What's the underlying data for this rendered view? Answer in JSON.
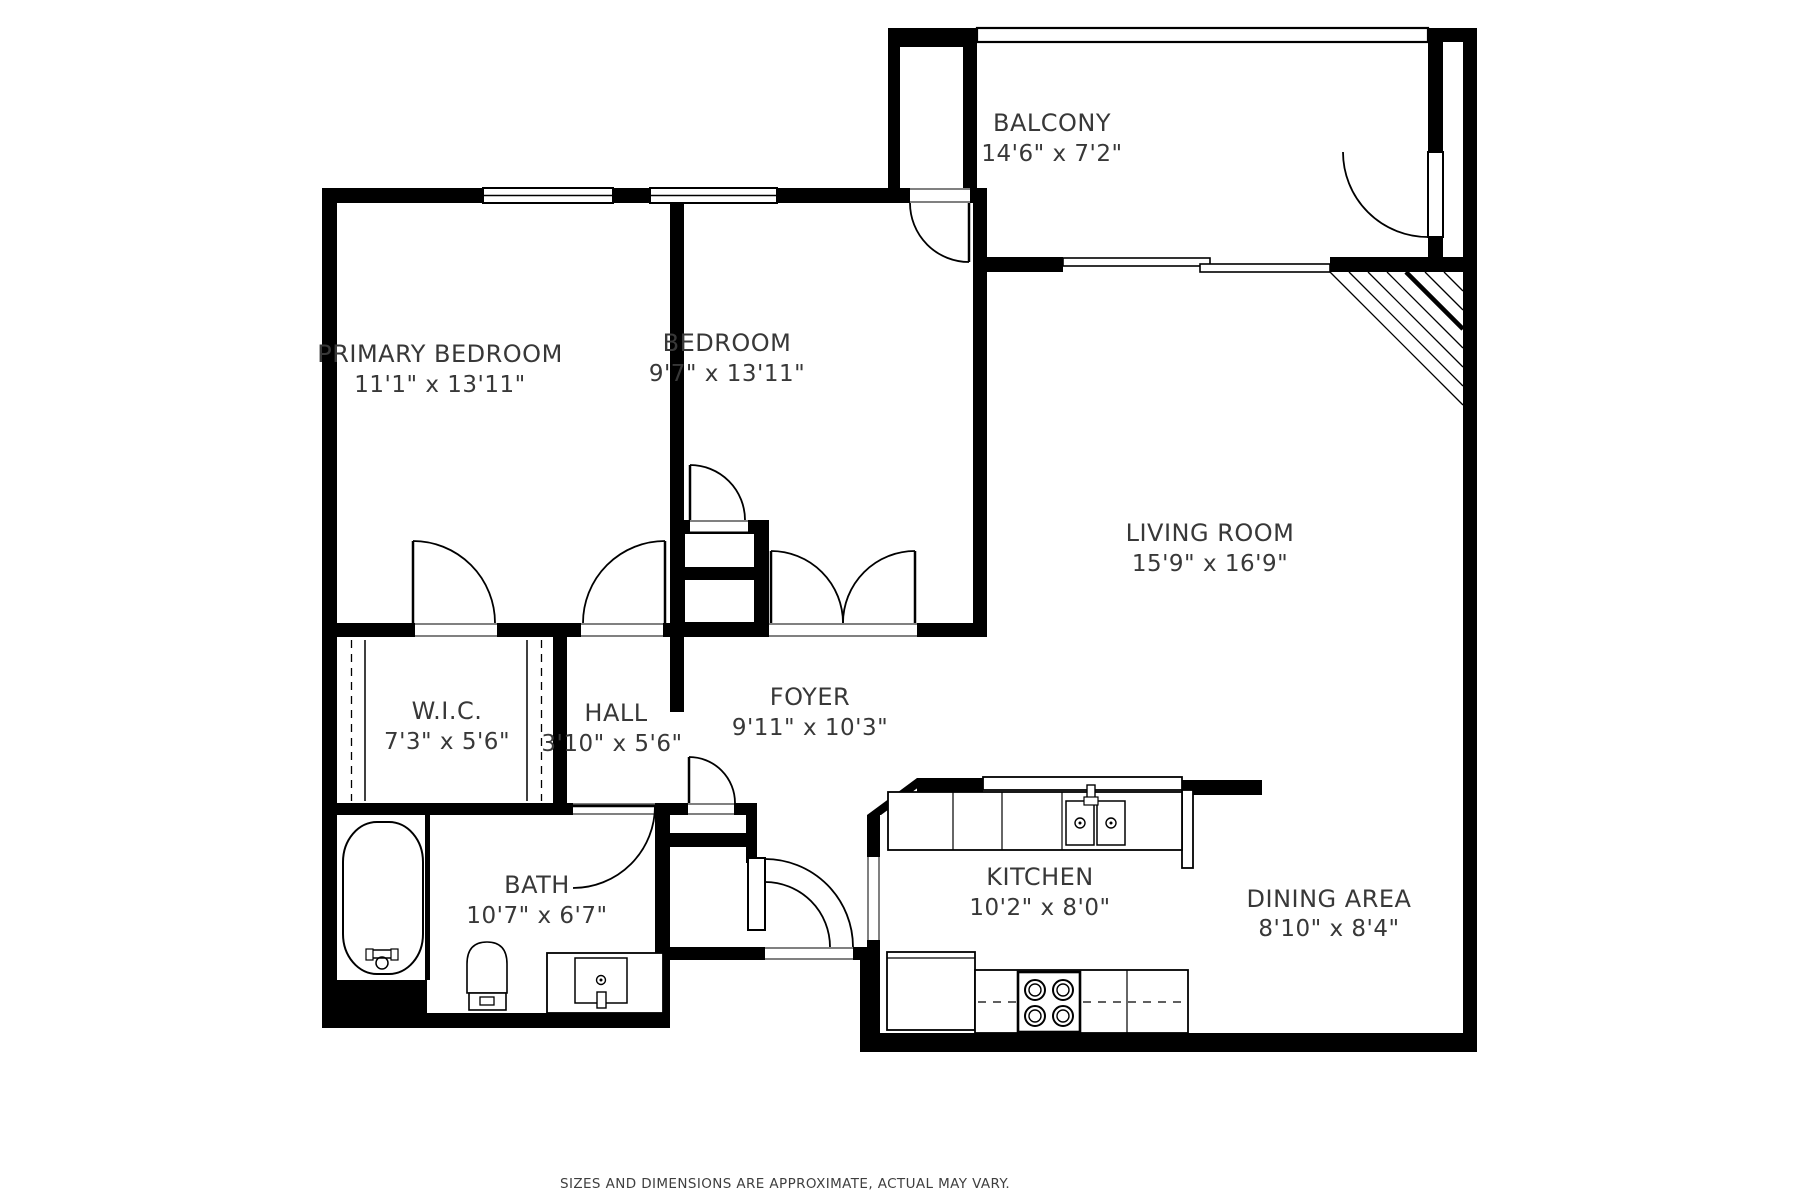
{
  "floorplan": {
    "rooms": [
      {
        "name": "PRIMARY BEDROOM",
        "dims": "11'1\" x 13'11\""
      },
      {
        "name": "BEDROOM",
        "dims": "9'7\" x 13'11\""
      },
      {
        "name": "BALCONY",
        "dims": "14'6\" x 7'2\""
      },
      {
        "name": "LIVING ROOM",
        "dims": "15'9\" x 16'9\""
      },
      {
        "name": "FOYER",
        "dims": "9'11\" x 10'3\""
      },
      {
        "name": "HALL",
        "dims": "3'10\" x 5'6\""
      },
      {
        "name": "W.I.C.",
        "dims": "7'3\" x 5'6\""
      },
      {
        "name": "BATH",
        "dims": "10'7\" x 6'7\""
      },
      {
        "name": "KITCHEN",
        "dims": "10'2\" x 8'0\""
      },
      {
        "name": "DINING AREA",
        "dims": "8'10\" x 8'4\""
      }
    ],
    "disclaimer": "SIZES AND DIMENSIONS ARE APPROXIMATE, ACTUAL MAY VARY.",
    "colors": {
      "wall": "#000000",
      "background": "#ffffff",
      "text": "#383838"
    }
  }
}
